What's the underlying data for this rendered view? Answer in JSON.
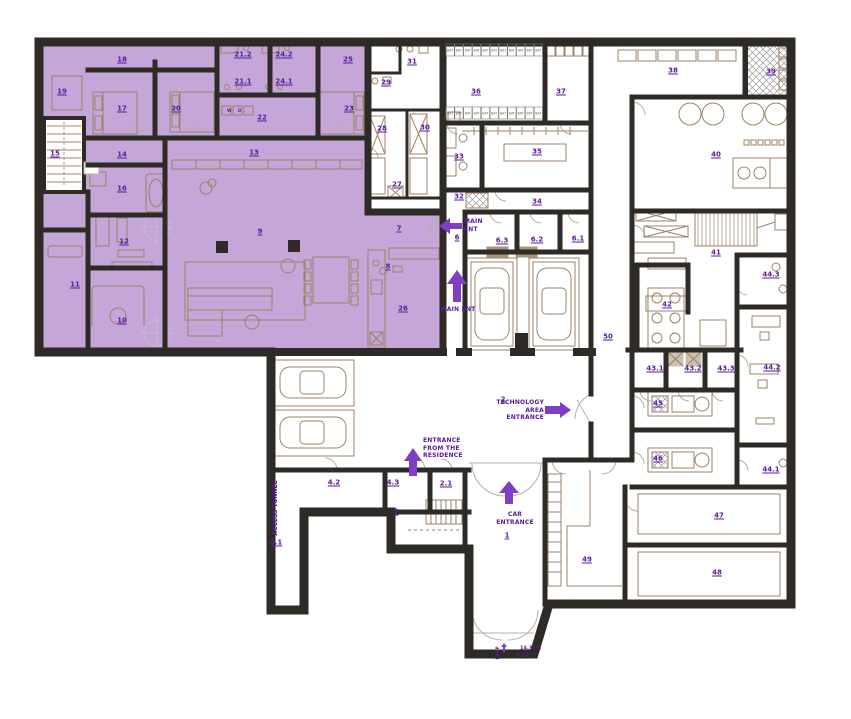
{
  "plan": {
    "colors": {
      "highlight": "#c5a6d9",
      "wall": "#2e2a26",
      "label": "#5a1a9a",
      "arrow": "#7e3fc4",
      "furniture": "#9c8266"
    },
    "rooms": [
      {
        "n": "1",
        "x": 507,
        "y": 536
      },
      {
        "n": "2",
        "x": 503,
        "y": 400
      },
      {
        "n": "2.1",
        "x": 446,
        "y": 484
      },
      {
        "n": "3",
        "x": 396,
        "y": 512
      },
      {
        "n": "4.1",
        "x": 276,
        "y": 543
      },
      {
        "n": "4.2",
        "x": 334,
        "y": 483
      },
      {
        "n": "4.3",
        "x": 393,
        "y": 483
      },
      {
        "n": "6",
        "x": 457,
        "y": 238
      },
      {
        "n": "6.1",
        "x": 578,
        "y": 239
      },
      {
        "n": "6.2",
        "x": 537,
        "y": 240
      },
      {
        "n": "6.3",
        "x": 502,
        "y": 241
      },
      {
        "n": "7",
        "x": 399,
        "y": 229
      },
      {
        "n": "8",
        "x": 388,
        "y": 267
      },
      {
        "n": "9",
        "x": 260,
        "y": 232
      },
      {
        "n": "10",
        "x": 122,
        "y": 321
      },
      {
        "n": "11",
        "x": 75,
        "y": 285
      },
      {
        "n": "12",
        "x": 124,
        "y": 242
      },
      {
        "n": "13",
        "x": 254,
        "y": 153
      },
      {
        "n": "14",
        "x": 122,
        "y": 155
      },
      {
        "n": "15",
        "x": 55,
        "y": 154
      },
      {
        "n": "16",
        "x": 122,
        "y": 189
      },
      {
        "n": "17",
        "x": 122,
        "y": 109
      },
      {
        "n": "18",
        "x": 122,
        "y": 60
      },
      {
        "n": "19",
        "x": 62,
        "y": 92
      },
      {
        "n": "20",
        "x": 176,
        "y": 109
      },
      {
        "n": "21.1",
        "x": 243,
        "y": 82
      },
      {
        "n": "21.2",
        "x": 243,
        "y": 55
      },
      {
        "n": "22",
        "x": 262,
        "y": 118
      },
      {
        "n": "23",
        "x": 349,
        "y": 109
      },
      {
        "n": "24.1",
        "x": 284,
        "y": 82
      },
      {
        "n": "24.2",
        "x": 284,
        "y": 55
      },
      {
        "n": "25",
        "x": 348,
        "y": 60
      },
      {
        "n": "26",
        "x": 403,
        "y": 309
      },
      {
        "n": "27",
        "x": 397,
        "y": 185
      },
      {
        "n": "28",
        "x": 382,
        "y": 129
      },
      {
        "n": "29",
        "x": 386,
        "y": 83
      },
      {
        "n": "30",
        "x": 425,
        "y": 128
      },
      {
        "n": "31",
        "x": 412,
        "y": 62
      },
      {
        "n": "32",
        "x": 459,
        "y": 197
      },
      {
        "n": "33",
        "x": 459,
        "y": 157
      },
      {
        "n": "34",
        "x": 537,
        "y": 202
      },
      {
        "n": "35",
        "x": 537,
        "y": 152
      },
      {
        "n": "36",
        "x": 476,
        "y": 92
      },
      {
        "n": "37",
        "x": 561,
        "y": 92
      },
      {
        "n": "38",
        "x": 673,
        "y": 71
      },
      {
        "n": "39",
        "x": 771,
        "y": 72
      },
      {
        "n": "40",
        "x": 716,
        "y": 155
      },
      {
        "n": "41",
        "x": 716,
        "y": 253
      },
      {
        "n": "42",
        "x": 667,
        "y": 305
      },
      {
        "n": "43.1",
        "x": 655,
        "y": 369
      },
      {
        "n": "43.2",
        "x": 693,
        "y": 369
      },
      {
        "n": "43.3",
        "x": 726,
        "y": 369
      },
      {
        "n": "44.1",
        "x": 771,
        "y": 470
      },
      {
        "n": "44.2",
        "x": 772,
        "y": 368
      },
      {
        "n": "44.3",
        "x": 771,
        "y": 275
      },
      {
        "n": "45",
        "x": 658,
        "y": 404
      },
      {
        "n": "46",
        "x": 658,
        "y": 459
      },
      {
        "n": "47",
        "x": 719,
        "y": 516
      },
      {
        "n": "48",
        "x": 717,
        "y": 573
      },
      {
        "n": "49",
        "x": 587,
        "y": 560
      },
      {
        "n": "50",
        "x": 608,
        "y": 337
      }
    ],
    "entrances": [
      {
        "label": "MAIN ENT",
        "x": 464,
        "y": 218,
        "w": 34,
        "align": "left"
      },
      {
        "label": "MAIN ENT",
        "x": 438,
        "y": 306,
        "w": 40,
        "align": "center"
      },
      {
        "label": "TECHNOLOGY AREA ENTRANCE",
        "x": 496,
        "y": 399,
        "w": 48,
        "align": "right"
      },
      {
        "label": "ENTRANCE FROM THE RESIDENCE",
        "x": 423,
        "y": 437,
        "w": 55,
        "align": "left"
      },
      {
        "label": "CAR ENTRANCE",
        "x": 490,
        "y": 511,
        "w": 50,
        "align": "center"
      }
    ],
    "annotations": [
      {
        "text": "ACCESS TUNNEL",
        "x": 276,
        "y": 508,
        "rot": true,
        "fs": 6
      },
      {
        "text": "RAMP",
        "x": 498,
        "y": 653,
        "rot": true,
        "fs": 4
      },
      {
        "text": "14.35%",
        "x": 520,
        "y": 649,
        "rot": false,
        "fs": 5
      },
      {
        "text": "8.13°",
        "x": 516,
        "y": 656,
        "rot": false,
        "fs": 5
      },
      {
        "text": "W",
        "x": 227,
        "y": 111,
        "rot": false,
        "fs": 4
      },
      {
        "text": "D",
        "x": 238,
        "y": 111,
        "rot": false,
        "fs": 4
      }
    ],
    "locker_label": "BAT"
  }
}
